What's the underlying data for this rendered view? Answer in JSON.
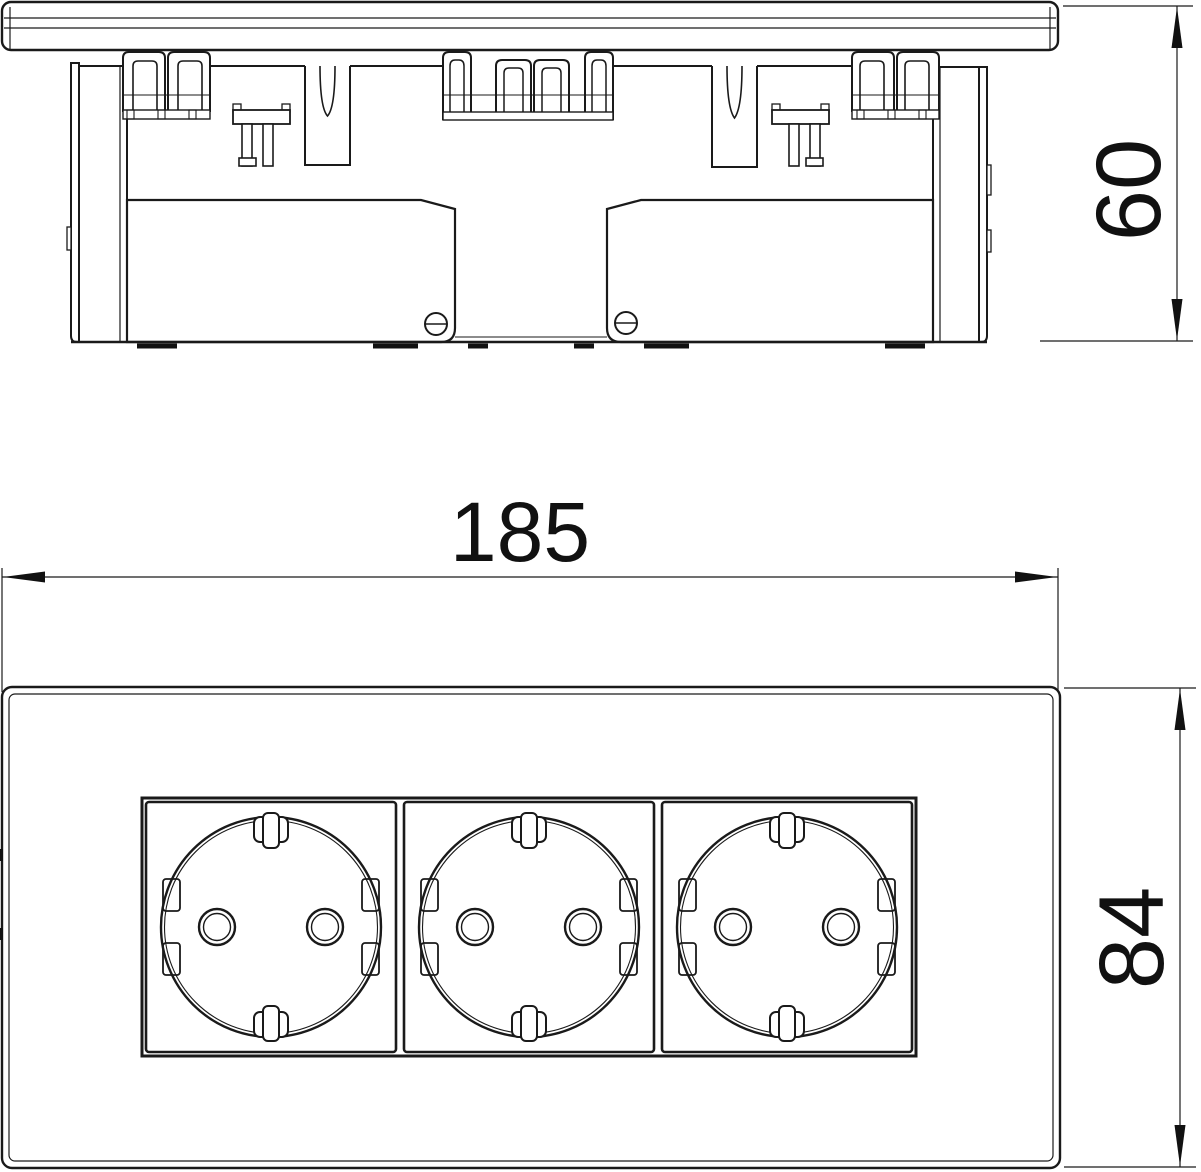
{
  "drawing": {
    "type": "technical dimension drawing",
    "subject": "triple socket outlet module, side profile and front view",
    "views": {
      "side_view": {
        "label": "side profile view"
      },
      "front_view": {
        "label": "front view with three socket gangs"
      }
    },
    "dimensions": {
      "width_mm": "185",
      "depth_mm": "60",
      "height_mm": "84"
    },
    "colors": {
      "line": "#1a1a1a",
      "background": "#ffffff",
      "text": "#111111"
    }
  }
}
